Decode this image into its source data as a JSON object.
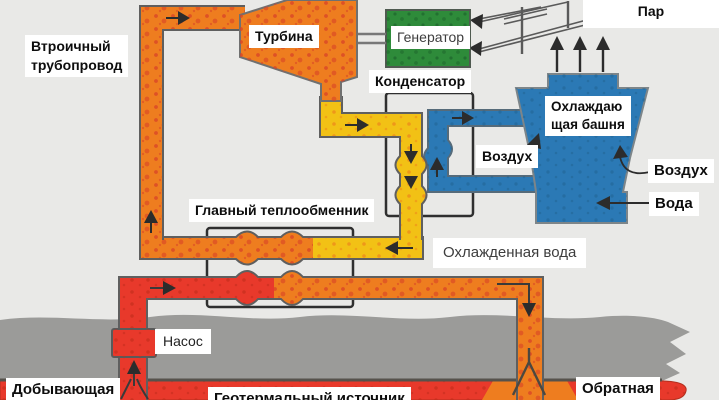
{
  "diagram": {
    "type": "geothermal-binary-power-plant-schematic",
    "labels": {
      "steam": "Пар",
      "secondary_pipeline_line1": "Втроичный",
      "secondary_pipeline_line2": "трубопровод",
      "turbine": "Турбина",
      "generator": "Генератор",
      "condenser": "Конденсатор",
      "cooling_tower_line1": "Охлаждаю",
      "cooling_tower_line2": "щая башня",
      "air_left": "Воздух",
      "air_right": "Воздух",
      "water": "Вода",
      "main_heat_exchanger": "Главный теплообменник",
      "cooled_water": "Охлажденная вода",
      "pump": "Насос",
      "production_well": "Добывающая",
      "geothermal_source": "Геотермальный источник",
      "return_well": "Обратная"
    },
    "colors": {
      "background": "#e9e9e7",
      "hot_pipe_orange": "#ee7d1f",
      "hot_pipe_red": "#e8392b",
      "warm_pipe_yellow": "#f2c115",
      "cold_water_blue": "#2b79b5",
      "generator_green": "#2e8b3a",
      "ground_gray": "#9b9b99",
      "outline_gray": "#5f5f5f",
      "flow_arrow_black": "#2c2c2c"
    }
  }
}
